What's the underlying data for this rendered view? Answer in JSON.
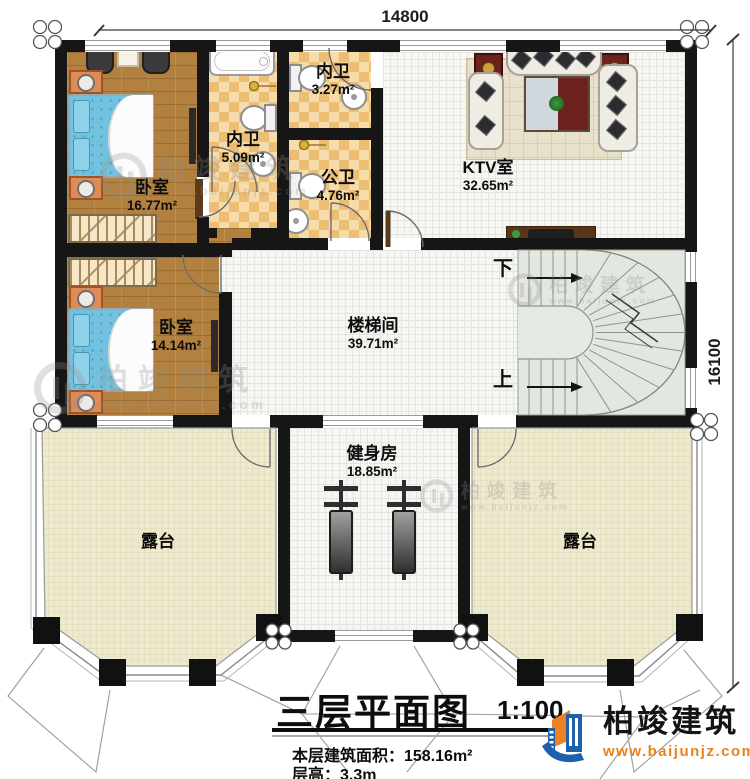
{
  "plan": {
    "dim_top": "14800",
    "dim_right": "16100",
    "stairs_down": "下",
    "stairs_up": "上"
  },
  "rooms": {
    "bedroom1": {
      "name": "卧室",
      "area": "16.77m²"
    },
    "bath_master": {
      "name": "内卫",
      "area": "5.09m²"
    },
    "bath_small": {
      "name": "内卫",
      "area": "3.27m²"
    },
    "bath_public": {
      "name": "公卫",
      "area": "4.76m²"
    },
    "ktv": {
      "name": "KTV室",
      "area": "32.65m²"
    },
    "stair_hall": {
      "name": "楼梯间",
      "area": "39.71m²"
    },
    "bedroom2": {
      "name": "卧室",
      "area": "14.14m²"
    },
    "gym": {
      "name": "健身房",
      "area": "18.85m²"
    },
    "terrace_left": {
      "name": "露台"
    },
    "terrace_right": {
      "name": "露台"
    }
  },
  "footer": {
    "title": "三层平面图",
    "scale": "1:100",
    "floor_area": "本层建筑面积：158.16m²",
    "floor_height": "层高：3.3m"
  },
  "brand": {
    "name": "柏竣建筑",
    "url": "www.baijunjz.com"
  },
  "watermark": {
    "name": "柏竣建筑",
    "url": "www.baijunjz.com"
  },
  "colors": {
    "wall": "#161616",
    "wood": "#b2813f",
    "tile_light": "#f7dcab",
    "tile_dark": "#ecbe74",
    "floor_light": "#f6f6f3",
    "terrace": "#edead0",
    "stairs": "#e2e7df",
    "logo_blue": "#1e5fae",
    "logo_orange": "#ee8222"
  }
}
